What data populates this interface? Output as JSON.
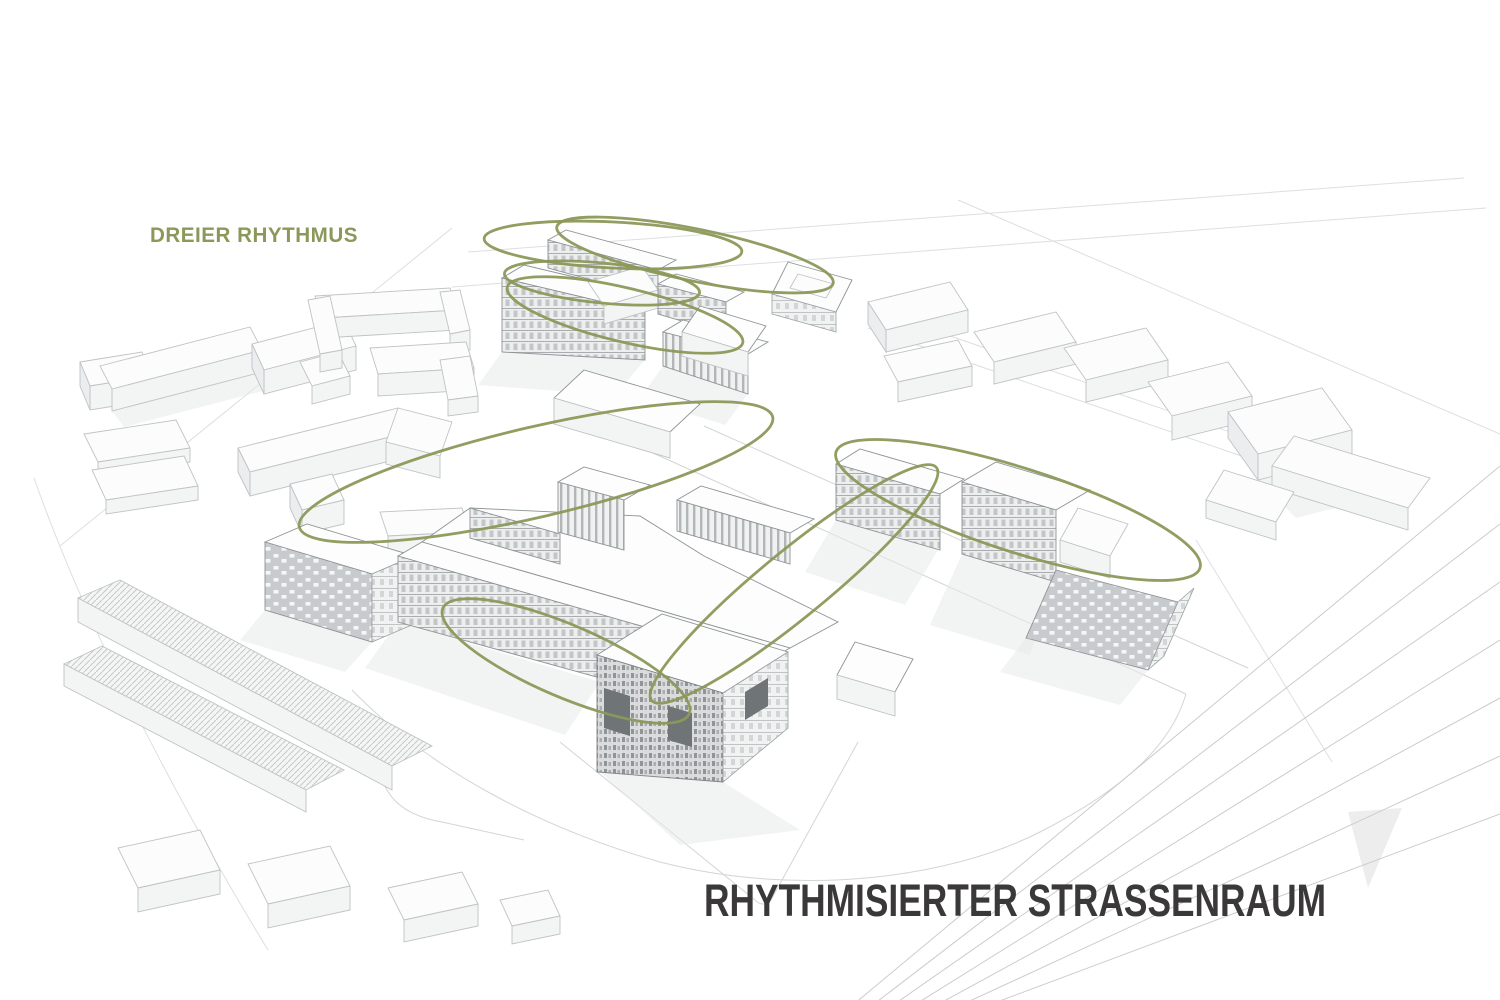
{
  "page": {
    "width": 1500,
    "height": 1000,
    "background": "#ffffff"
  },
  "colors": {
    "accent_olive": "#8b9859",
    "title_dark": "#3b3839",
    "linework_light": "#c3c7c9",
    "linework_medium": "#8d9395"
  },
  "labels": {
    "concept_label": "DREIER RHYTHMUS",
    "main_title": "RHYTHMISIERTER STRASSENRAUM"
  },
  "diagram": {
    "type": "architectural-axonometric-concept-diagram",
    "subject": "urban masterplan massing with rhythm ellipses over street space",
    "rhythm_ellipses": [
      {
        "id": "north-row-1",
        "cx": 695,
        "cy": 255,
        "rx": 141,
        "ry": 26,
        "rotation": 11.5
      },
      {
        "id": "north-row-2",
        "cx": 613,
        "cy": 245,
        "rx": 129,
        "ry": 23,
        "rotation": 2.9
      },
      {
        "id": "north-row-3",
        "cx": 602,
        "cy": 283,
        "rx": 98,
        "ry": 20,
        "rotation": 5.6
      },
      {
        "id": "north-row-4",
        "cx": 625,
        "cy": 315,
        "rx": 121,
        "ry": 27,
        "rotation": 13.3
      },
      {
        "id": "west-long",
        "cx": 536,
        "cy": 472,
        "rx": 243,
        "ry": 45,
        "rotation": -13.1
      },
      {
        "id": "south-short",
        "cx": 566,
        "cy": 661,
        "rx": 134,
        "ry": 36,
        "rotation": 23.2
      },
      {
        "id": "east-long",
        "cx": 1018,
        "cy": 510,
        "rx": 191,
        "ry": 42,
        "rotation": 17.7
      },
      {
        "id": "diagonal",
        "cx": 794,
        "cy": 584,
        "rx": 184,
        "ry": 33,
        "rotation": -39.3
      }
    ]
  }
}
